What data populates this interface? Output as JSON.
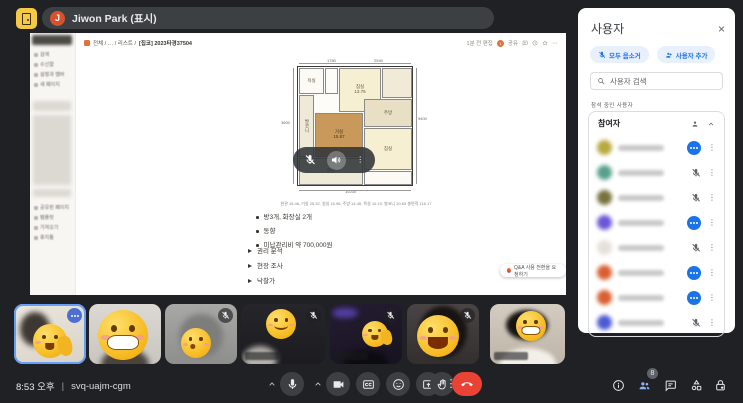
{
  "colors": {
    "accent_blue": "#1a73e8",
    "light_blue_chip": "#e8f0fe",
    "danger_red": "#ea4335",
    "dark_bg": "#202124",
    "control_gray": "#3c4043",
    "active_people_blue": "#8ab4f8"
  },
  "top_bar": {
    "presenter": {
      "initial": "J",
      "label": "Jiwon Park (표시)"
    }
  },
  "shared_screen": {
    "breadcrumb": {
      "path": "전체  /  …  /  리스트  /",
      "page": "[집코] 2023타경37504"
    },
    "topbar_right": {
      "edited": "1분 전 편집",
      "avatar_count": "1",
      "share_label": "공유"
    },
    "sidebar": {
      "top_items": [
        "검색",
        "수신함",
        "설정과 멤버",
        "새 페이지"
      ],
      "bottom_items": [
        "공유된 페이지",
        "템플릿",
        "가져오기",
        "휴지통"
      ]
    },
    "floor_plan": {
      "rooms": {
        "bath": "욕실",
        "bed_top": "침실",
        "bed_top_area": "13.75",
        "balcony": "발코니",
        "living": "거실",
        "living_area": "15.87",
        "kitchen": "주방",
        "bed_bottom": "침실",
        "entrance": "현관"
      },
      "dimensions": {
        "top_left": "1780",
        "top_right": "2540",
        "right": "9400",
        "left": "3600",
        "bottom": "10230"
      },
      "caption": "현관 15.46, 거실 25.32, 침실 16.96, 주방 14.45, 욕실 10.19, 발코니 20.63 총면적 116.17"
    },
    "bullets": [
      "방3개, 화장실 2개",
      "동향",
      "미납관리비 약 700,000원"
    ],
    "toggles": [
      "권리 분석",
      "현장 조사",
      "낙찰가"
    ],
    "qa_button": "Q&A 사용 전환을 요청하기"
  },
  "panel": {
    "title": "사용자",
    "close": "×",
    "buttons": [
      {
        "label": "모두 음소거"
      },
      {
        "label": "사용자 추가"
      }
    ],
    "search_placeholder": "사용자 검색",
    "section_label": "참석 중인 사용자",
    "group": {
      "title": "참여자",
      "count": "8"
    },
    "participants": [
      {
        "avatar_color": "#b9a83e",
        "status": "speaking"
      },
      {
        "avatar_color": "#58a08c",
        "status": "muted"
      },
      {
        "avatar_color": "#77713c",
        "status": "muted"
      },
      {
        "avatar_color": "#6a57d6",
        "status": "speaking"
      },
      {
        "avatar_color": "#e5e1da",
        "status": "muted"
      },
      {
        "avatar_color": "#d95f31",
        "status": "speaking"
      },
      {
        "avatar_color": "#d95f31",
        "status": "speaking"
      },
      {
        "avatar_color": "#4d5bd3",
        "status": "muted"
      }
    ]
  },
  "filmstrip": {
    "tiles": [
      {
        "emoji": "wave",
        "speaking": true,
        "muted": false,
        "name_label": false
      },
      {
        "emoji": "grin",
        "speaking": false,
        "muted": false,
        "name_label": false
      },
      {
        "emoji": "kiss",
        "speaking": false,
        "muted": true,
        "name_label": false
      },
      {
        "emoji": "smile",
        "speaking": false,
        "muted": true,
        "name_label": true
      },
      {
        "emoji": "wave",
        "speaking": false,
        "muted": true,
        "name_label": true
      },
      {
        "emoji": "laugh",
        "speaking": false,
        "muted": true,
        "name_label": false
      },
      {
        "emoji": "grin",
        "speaking": false,
        "muted": false,
        "name_label": true
      }
    ]
  },
  "bottom_bar": {
    "time": "8:53 오후",
    "separator": "|",
    "meeting_code": "svq-uajm-cgm",
    "people_badge": "8"
  }
}
